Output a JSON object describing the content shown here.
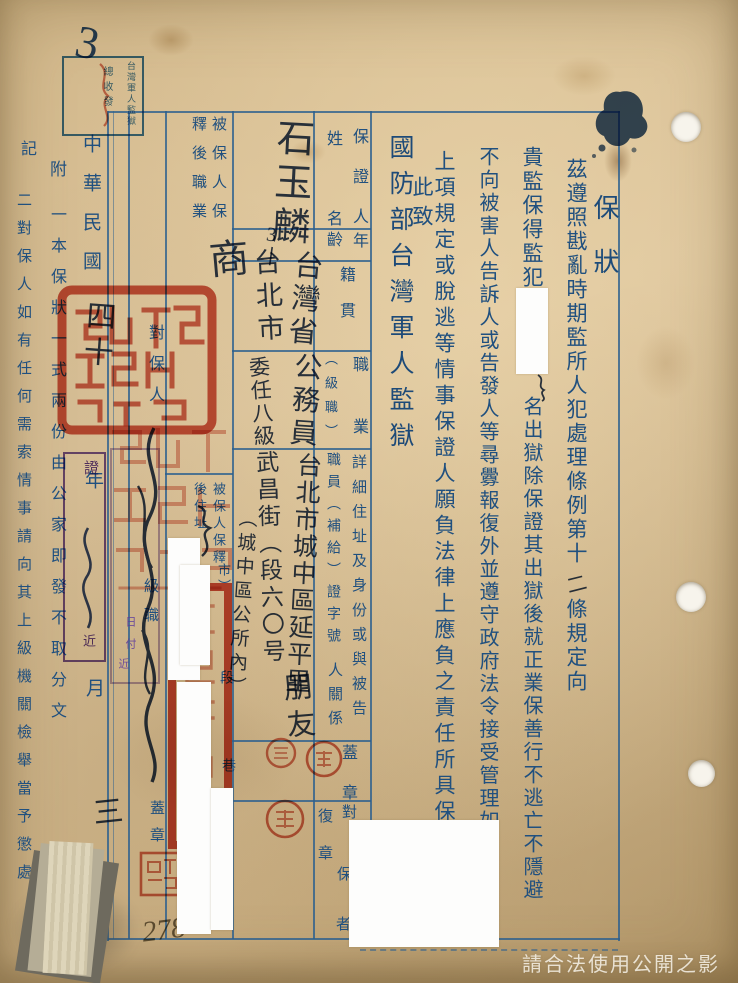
{
  "document": {
    "title": "保狀",
    "registry_stamp": {
      "line1": "台灣軍人監獄",
      "line2": "總收發",
      "handwritten_number": "3"
    },
    "body": {
      "col1_part1": "茲遵照戡亂時期監所人犯處理條例第十",
      "col1_insert": "二",
      "col1_part2": "條規定向",
      "col2_part1": "貴監保得監犯",
      "col2_part2": "名出獄除保證其出獄後就正業保善行不逃亡不隱避",
      "col3": "不向被害人告訴人或告發人等尋釁報復外並遵守政府法令接受管理如有違背",
      "col4": "上項規定或脫逃等情事保證人願負法律上應負之責任所具保狀是實",
      "closing": "此致",
      "recipient": "國防部台灣軍人監獄"
    },
    "form": {
      "guarantor_header": "保證人",
      "name_label": "姓名",
      "name_value": "石玉麟",
      "age_label_top": "年",
      "age_label_bottom": "齡",
      "age_value": "3丨",
      "origin_label": "籍貫",
      "origin_value_1": "台灣省",
      "origin_value_2": "台北市",
      "occupation_label": "職業",
      "occupation_rank_label": "（級職）",
      "occupation_value": "公務員",
      "occupation_rank_value": "委任八級",
      "address_label": "詳細住址及身份或與被告",
      "address_label2": "人關係",
      "cert_label": "職員（補給）證字號",
      "address_value_1": "台北市城中區延平里",
      "address_value_2": "武昌街（段六〇号",
      "address_value_3": "（城中區公所內）",
      "relation_value": "朋友",
      "seal_label": "蓋章",
      "verify_char_1": "對",
      "verify_char_2": "保",
      "verify_char_3": "者",
      "reseal_label": "復章",
      "released_occupation_label_1": "被保人保",
      "released_occupation_label_2": "釋後職業",
      "released_occupation_value": "商",
      "released_address_label_1": "被保人保釋",
      "released_address_label_2": "後住址",
      "template_city": "市）",
      "template_duan": "段",
      "template_lane": "巷",
      "verifier_label": "對保人",
      "verifier_rank_label": "級職",
      "verifier_seal_label": "蓋章"
    },
    "date": {
      "era": "中華民國",
      "year_hw": "四十",
      "year": "年",
      "month": "月",
      "day_hw": "三",
      "day": "日"
    },
    "stamps": {
      "purple_a_char": "證",
      "purple_a_char2": "近",
      "purple_b_1": "日",
      "purple_b_2": "付",
      "purple_b_3": "近"
    },
    "notes": {
      "fu": "附",
      "note1": "一本保狀一式兩份由公家即發不取分文",
      "ji": "記",
      "note2": "二對保人如有任何需索情事請向其上級機關檢舉當予懲處"
    },
    "annotations": {
      "pencil": "278",
      "watermark": "請合法使用公開之影像"
    }
  }
}
